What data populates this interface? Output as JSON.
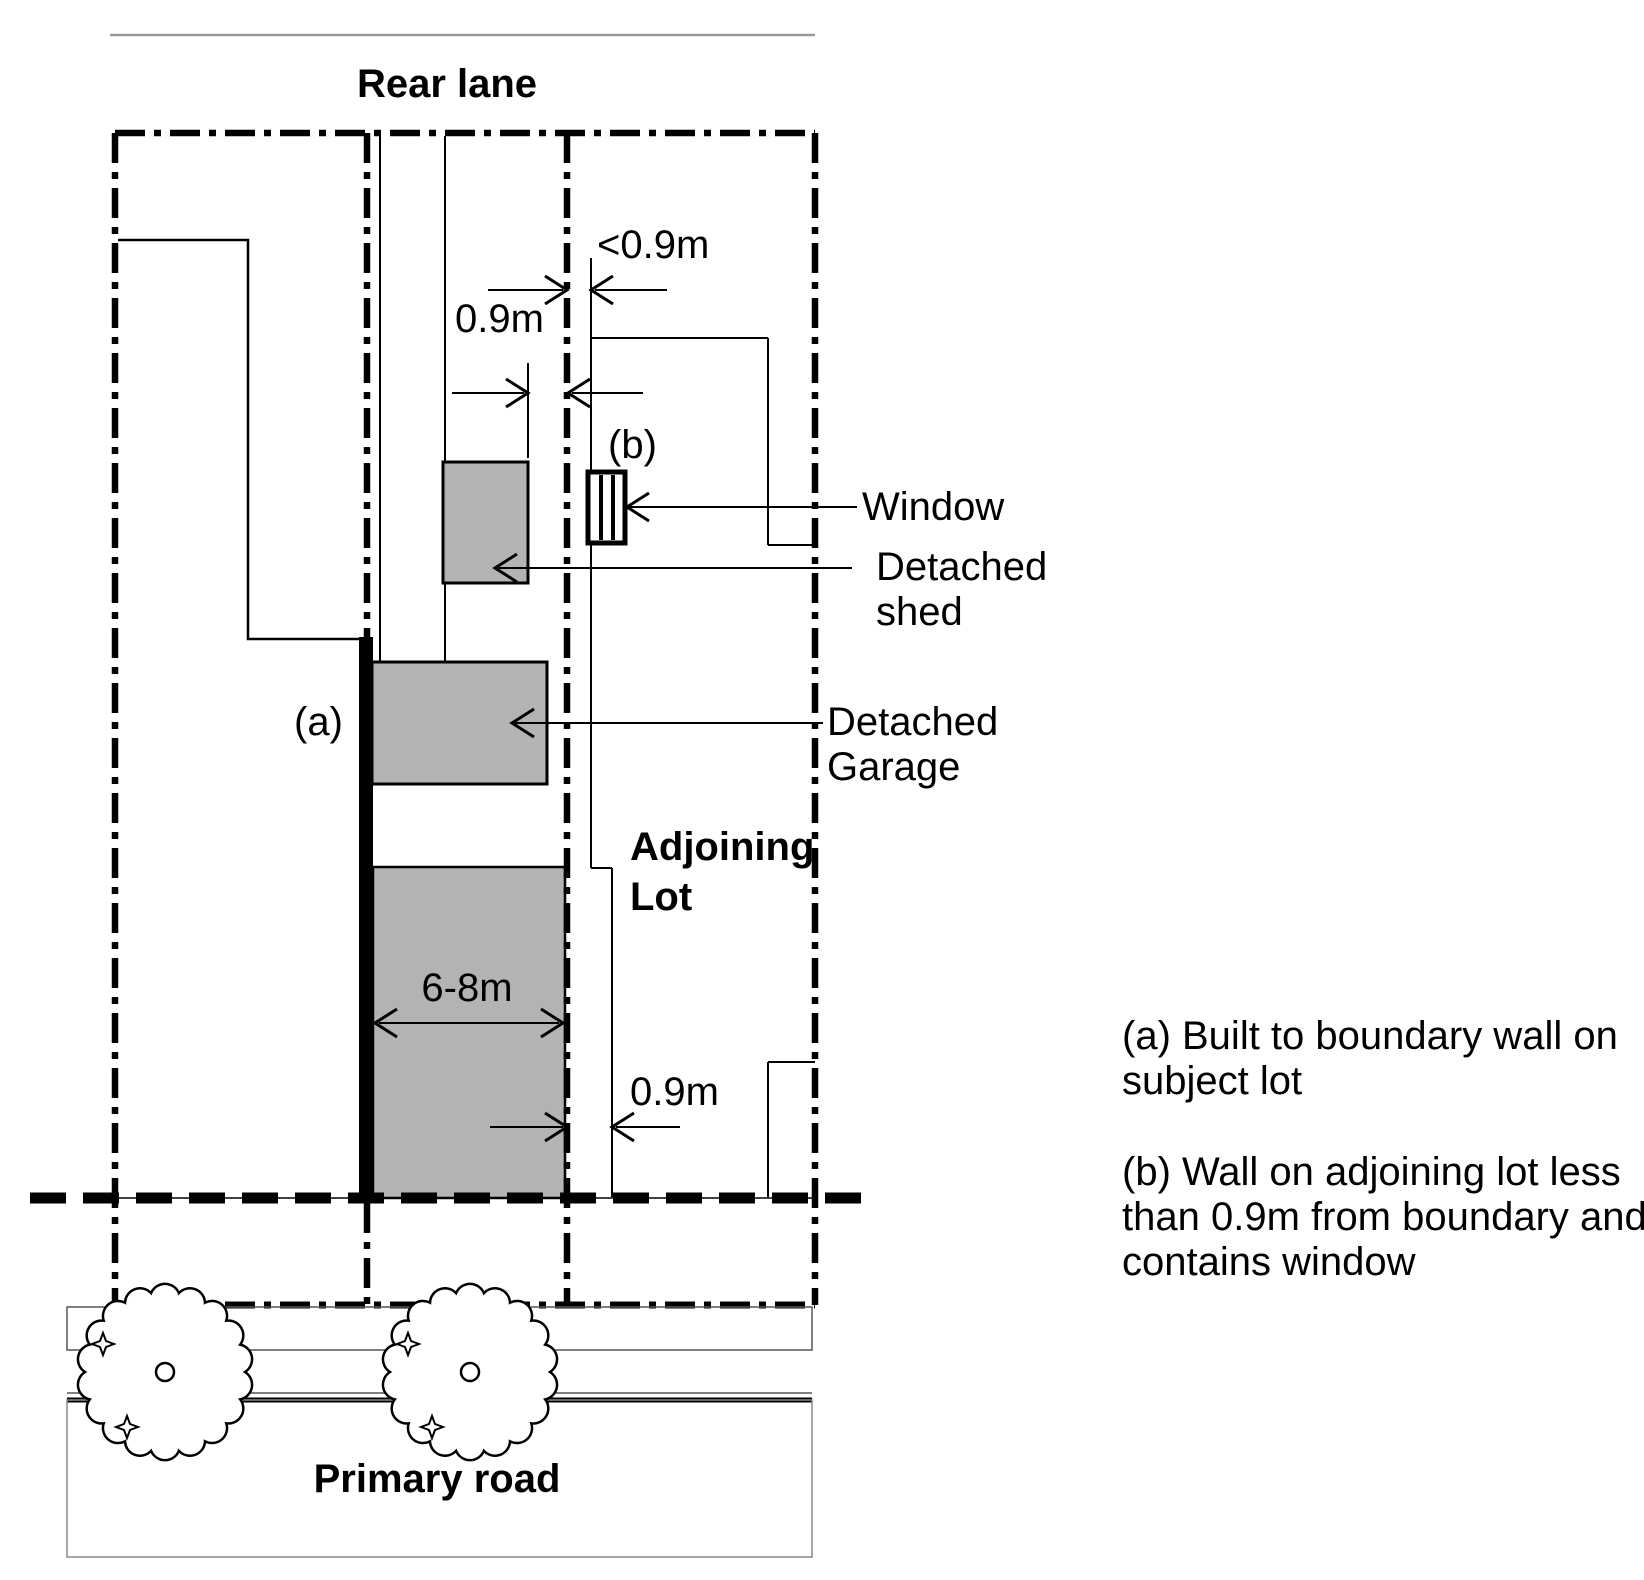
{
  "diagram": {
    "rear_lane_label": "Rear lane",
    "primary_road_label": "Primary road",
    "adjoining_lot_label_line1": "Adjoining",
    "adjoining_lot_label_line2": "Lot",
    "marker_a": "(a)",
    "marker_b": "(b)",
    "window_label": "Window",
    "detached_shed_label_line1": "Detached",
    "detached_shed_label_line2": "shed",
    "detached_garage_label_line1": "Detached",
    "detached_garage_label_line2": "Garage",
    "dim_window_wall_setback": "<0.9m",
    "dim_shed_boundary_setback": "0.9m",
    "dim_dwelling_width": "6-8m",
    "dim_adjoining_house_setback": "0.9m"
  },
  "legend": {
    "a_lines": [
      "(a) Built to boundary wall on",
      "subject lot"
    ],
    "b_lines": [
      "(b) Wall on adjoining lot less",
      "than 0.9m from boundary and",
      "contains window"
    ]
  },
  "colors": {
    "building_fill": "#b3b3b3",
    "line": "#000000",
    "lane_edge": "#999999"
  }
}
